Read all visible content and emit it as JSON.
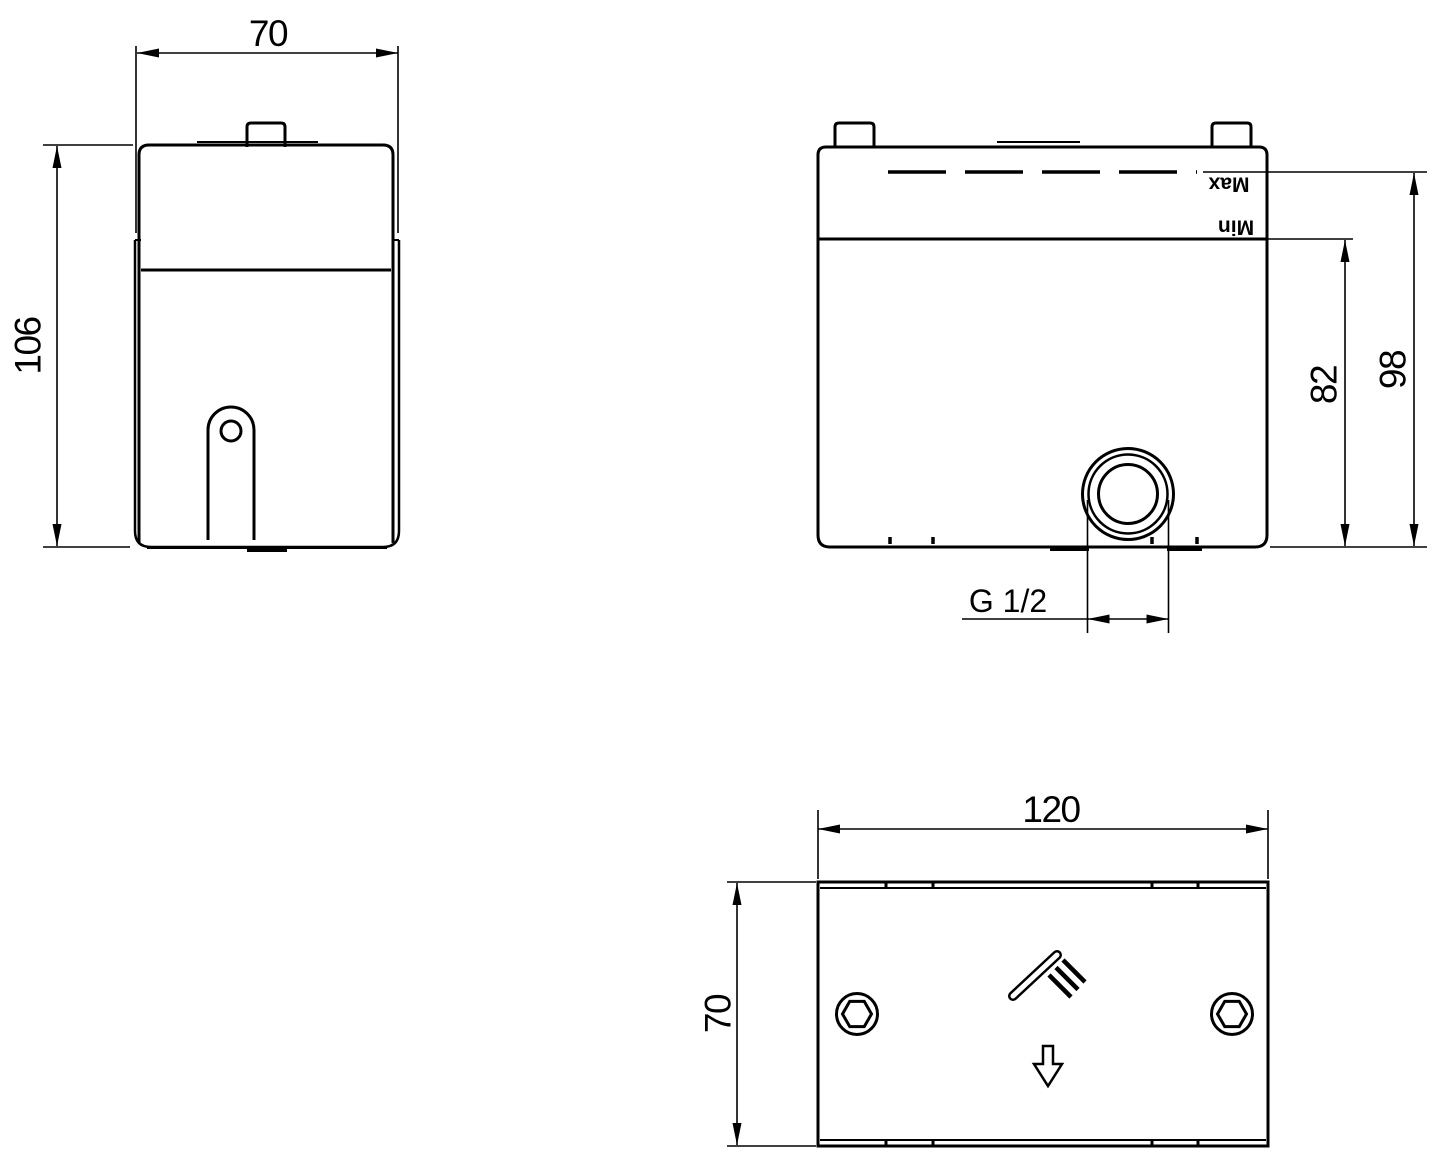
{
  "meta": {
    "drawing_type": "technical dimension drawing, concealed valve body (3 views)",
    "background_color": "#ffffff",
    "line_color": "#000000"
  },
  "side_view": {
    "width_label": "70",
    "height_label": "106"
  },
  "front_view": {
    "max_label": "Max",
    "min_label": "Min",
    "min_depth_label": "82",
    "max_depth_label": "98",
    "thread_label": "G 1/2"
  },
  "bottom_view": {
    "width_label": "120",
    "depth_label": "70"
  }
}
